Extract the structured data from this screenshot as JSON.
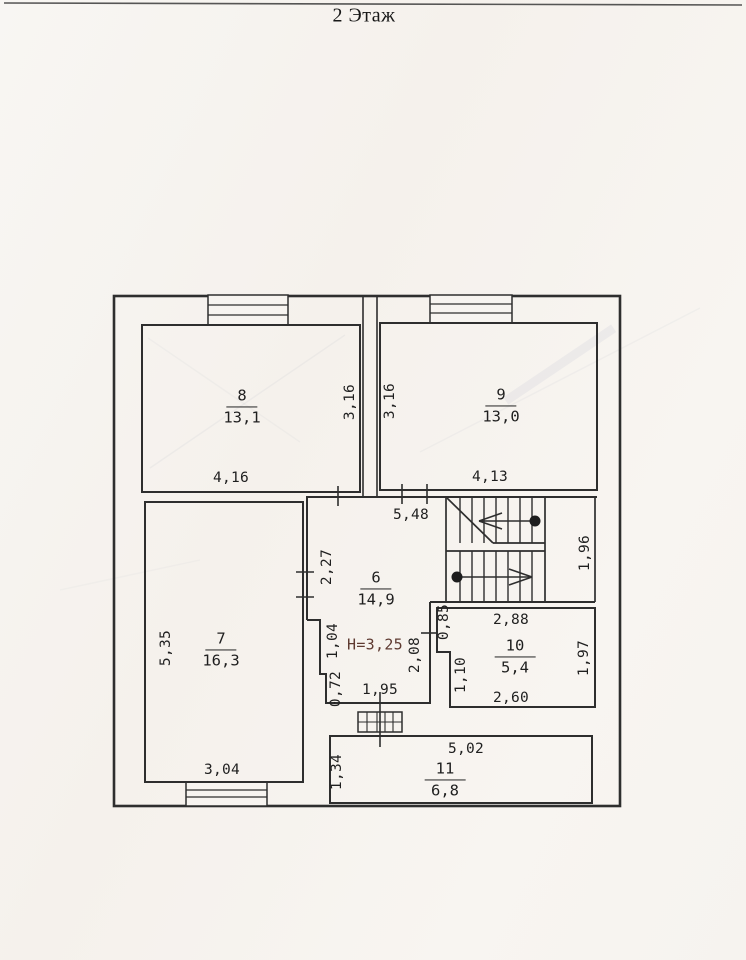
{
  "page_title": "2 Этаж",
  "floor_plan": {
    "rooms": [
      {
        "number": "8",
        "area": "13,1"
      },
      {
        "number": "9",
        "area": "13,0"
      },
      {
        "number": "6",
        "area": "14,9"
      },
      {
        "number": "7",
        "area": "16,3"
      },
      {
        "number": "10",
        "area": "5,4"
      },
      {
        "number": "11",
        "area": "6,8"
      }
    ],
    "ceiling_height_note": "H=3,25",
    "dimensions": [
      {
        "value": "4,16",
        "room": "8",
        "orientation": "horizontal"
      },
      {
        "value": "3,16",
        "room": "8",
        "orientation": "vertical"
      },
      {
        "value": "3,16",
        "room": "9",
        "orientation": "vertical"
      },
      {
        "value": "4,13",
        "room": "9",
        "orientation": "horizontal"
      },
      {
        "value": "5,48",
        "room": "6",
        "orientation": "horizontal"
      },
      {
        "value": "2,27",
        "room": "6",
        "orientation": "vertical"
      },
      {
        "value": "1,04",
        "room": "6",
        "orientation": "vertical"
      },
      {
        "value": "0,72",
        "room": "6",
        "orientation": "vertical"
      },
      {
        "value": "1,95",
        "room": "6",
        "orientation": "horizontal"
      },
      {
        "value": "2,08",
        "room": "6",
        "orientation": "vertical"
      },
      {
        "value": "0,85",
        "room": "10",
        "orientation": "vertical"
      },
      {
        "value": "2,88",
        "room": "10",
        "orientation": "horizontal"
      },
      {
        "value": "1,10",
        "room": "10",
        "orientation": "vertical"
      },
      {
        "value": "2,60",
        "room": "10",
        "orientation": "horizontal"
      },
      {
        "value": "1,97",
        "room": "10",
        "orientation": "vertical"
      },
      {
        "value": "1,96",
        "room": "stairs",
        "orientation": "vertical"
      },
      {
        "value": "5,02",
        "room": "11",
        "orientation": "horizontal"
      },
      {
        "value": "1,34",
        "room": "11",
        "orientation": "vertical"
      },
      {
        "value": "3,04",
        "room": "7",
        "orientation": "horizontal"
      },
      {
        "value": "5,35",
        "room": "7",
        "orientation": "vertical"
      }
    ]
  },
  "colors": {
    "ink": "#2e2e2e",
    "height_note_ink": "#5e3a31",
    "paper": "#f7f4f0"
  }
}
